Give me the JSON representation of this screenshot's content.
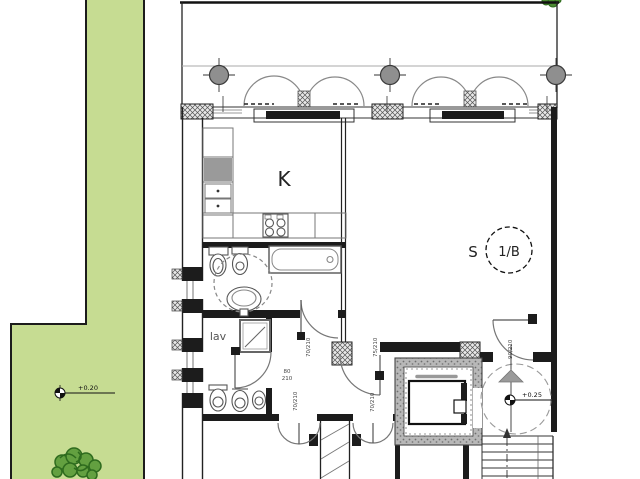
{
  "plan": {
    "kitchen_label": "K",
    "room_s_label": "S",
    "unit_label": "1/B",
    "lav_label": "lav",
    "levels": {
      "garden": "+0.20",
      "stair": "+0.25"
    },
    "door_labels": {
      "stack_top": "80",
      "stack_bottom": "210",
      "lav_door": "70/210",
      "hall_left": "70/210",
      "hall_right": "70/210",
      "room_s_door": "75/210",
      "spiral_door": "90/210"
    },
    "colors": {
      "garden_green": "#c6dc92",
      "shrub_green": "#63a040",
      "shrub_stroke": "#2e6b1e",
      "wall_black": "#1c1c1c",
      "line_gray": "#8a8a8a",
      "column_gray": "#8f8f8f",
      "shaft_gray": "#b8b8b8"
    }
  }
}
